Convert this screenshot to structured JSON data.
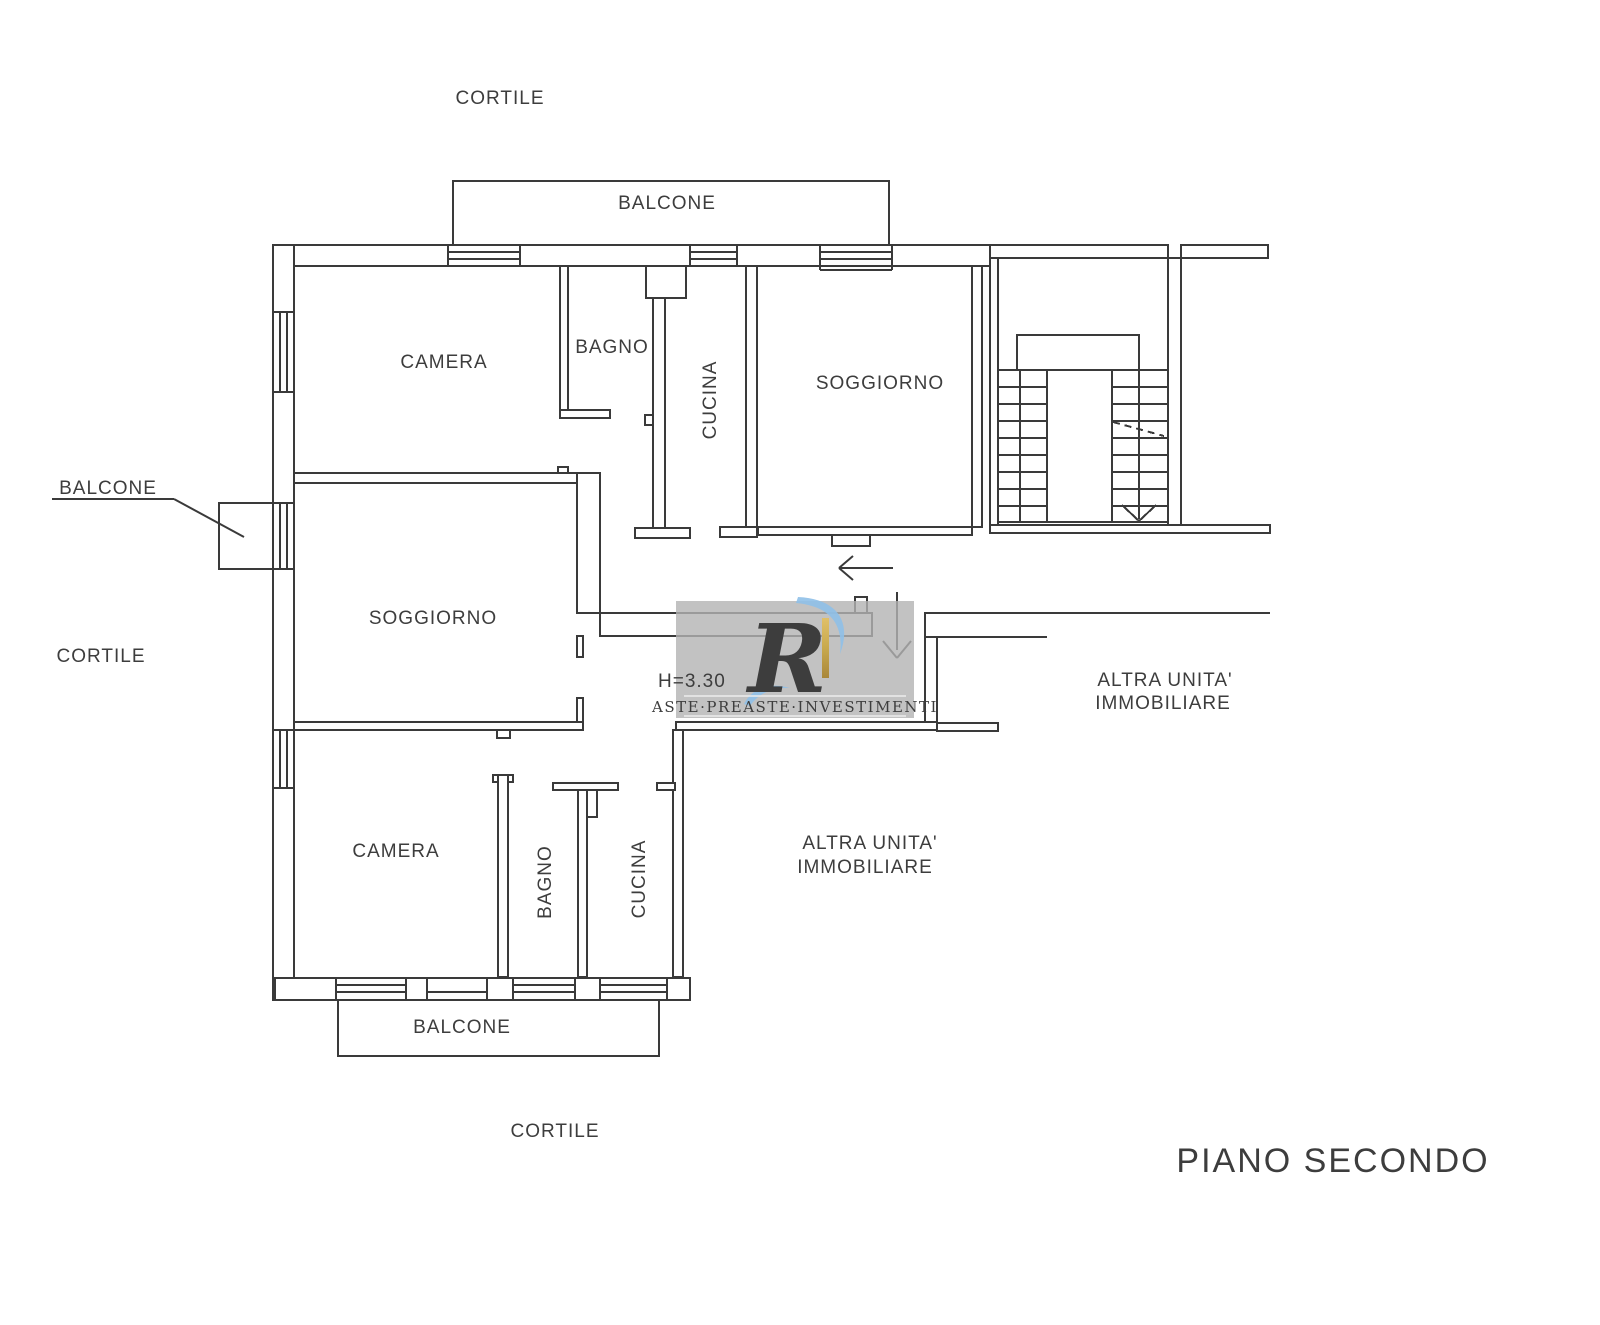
{
  "page": {
    "title": "PIANO SECONDO",
    "background": "#ffffff"
  },
  "colors": {
    "line": "#3a3a3a",
    "label_text": "#3d3d3d",
    "watermark_background": "#b3b3b3",
    "watermark_gold": "#c8a94e",
    "watermark_blue": "#8fc0e8"
  },
  "floor_plan": {
    "floor_title": "PIANO SECONDO",
    "height_annotation": "H=3.30",
    "labels": [
      {
        "id": "cortile-top",
        "text": "CORTILE"
      },
      {
        "id": "balcone-top",
        "text": "BALCONE"
      },
      {
        "id": "camera-top",
        "text": "CAMERA"
      },
      {
        "id": "bagno-top",
        "text": "BAGNO"
      },
      {
        "id": "cucina-top",
        "text": "CUCINA"
      },
      {
        "id": "soggiorno-top",
        "text": "SOGGIORNO"
      },
      {
        "id": "balcone-left",
        "text": "BALCONE"
      },
      {
        "id": "cortile-left",
        "text": "CORTILE"
      },
      {
        "id": "soggiorno-middle",
        "text": "SOGGIORNO"
      },
      {
        "id": "height-annotation",
        "text": "H=3.30"
      },
      {
        "id": "altra-unita-right-1",
        "text": "ALTRA UNITA'"
      },
      {
        "id": "altra-unita-right-2",
        "text": "IMMOBILIARE"
      },
      {
        "id": "camera-bottom",
        "text": "CAMERA"
      },
      {
        "id": "bagno-bottom",
        "text": "BAGNO"
      },
      {
        "id": "cucina-bottom",
        "text": "CUCINA"
      },
      {
        "id": "altra-unita-center-1",
        "text": "ALTRA UNITA'"
      },
      {
        "id": "altra-unita-center-2",
        "text": "IMMOBILIARE"
      },
      {
        "id": "balcone-bottom",
        "text": "BALCONE"
      },
      {
        "id": "cortile-bottom",
        "text": "CORTILE"
      },
      {
        "id": "piano-title",
        "text": "PIANO SECONDO"
      }
    ],
    "watermark": {
      "monogram": "R",
      "wordmark": "ASTE·PREASTE·INVESTIMENTI"
    }
  }
}
